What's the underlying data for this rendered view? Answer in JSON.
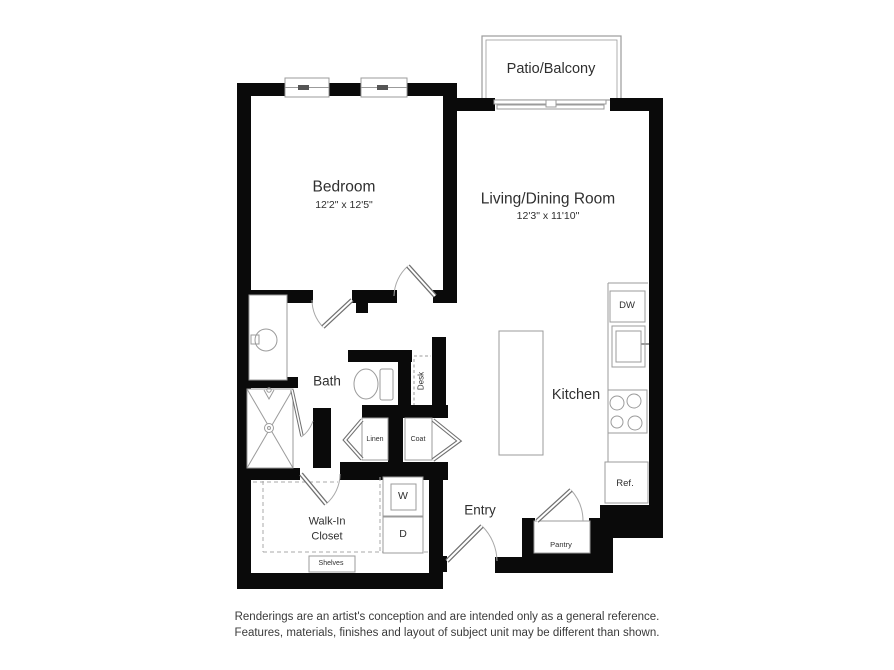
{
  "colors": {
    "wall": "#0a0a0a",
    "fixture_line": "#9b9b9b",
    "door_line": "#707070",
    "text": "#2f2f2f"
  },
  "rooms": {
    "patio": {
      "label": "Patio/Balcony"
    },
    "bedroom": {
      "label": "Bedroom",
      "dims": "12'2\" x 12'5\""
    },
    "living": {
      "label": "Living/Dining Room",
      "dims": "12'3\" x 11'10\""
    },
    "bath": {
      "label": "Bath"
    },
    "kitchen": {
      "label": "Kitchen"
    },
    "entry": {
      "label": "Entry"
    },
    "walk_in_closet": {
      "line1": "Walk-In",
      "line2": "Closet"
    }
  },
  "fixtures": {
    "desk": "Desk",
    "linen": "Linen",
    "coat": "Coat",
    "washer": "W",
    "dryer": "D",
    "dishwasher": "DW",
    "refrigerator": "Ref.",
    "pantry": "Pantry",
    "shelves": "Shelves"
  },
  "disclaimer": {
    "line1": "Renderings are an artist's conception and are intended only as a general reference.",
    "line2": "Features, materials, finishes and layout of subject unit may be different than shown."
  }
}
